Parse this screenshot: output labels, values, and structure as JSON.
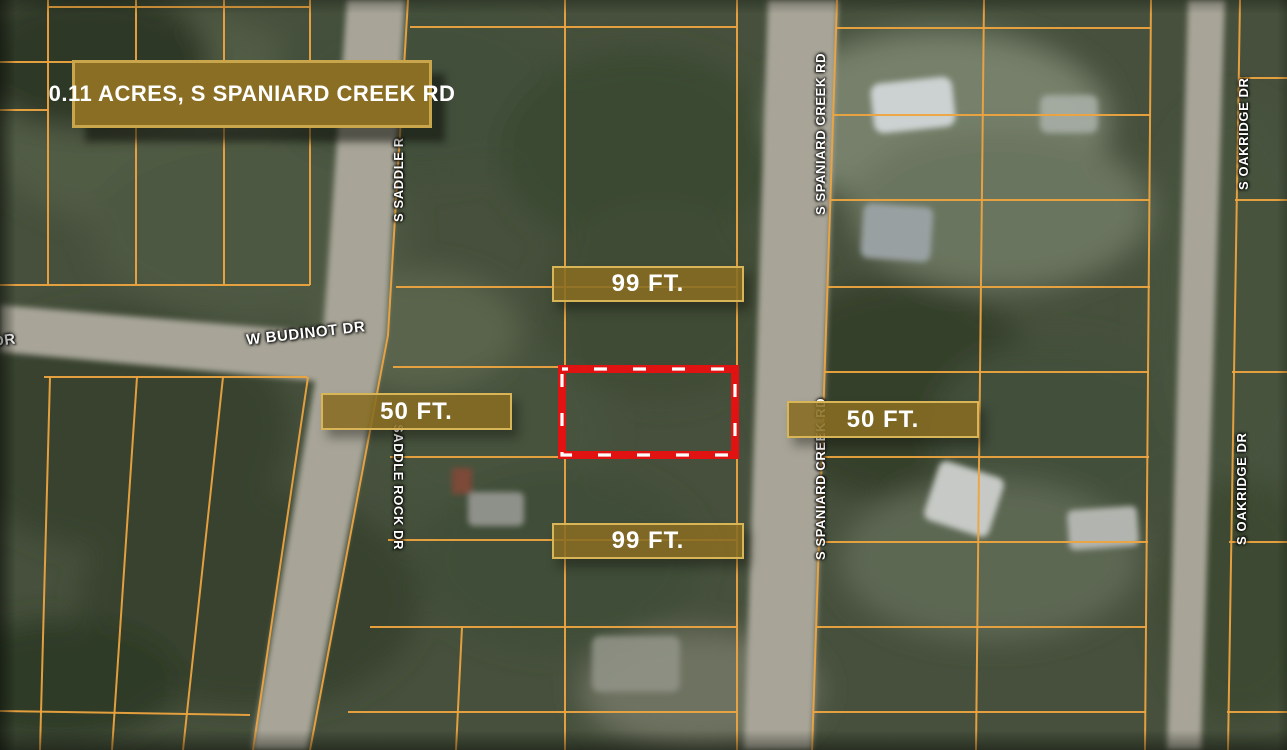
{
  "map": {
    "title_banner": "0.11 ACRES, S SPANIARD CREEK RD",
    "dimensions": {
      "top": "99 FT.",
      "bottom": "99 FT.",
      "left": "50 FT.",
      "right": "50 FT."
    },
    "streets": {
      "budinot": "W BUDINOT DR",
      "left_partial": "DR",
      "saddle_upper": "S SADDLE R",
      "saddle_lower": "SADDLE ROCK DR",
      "spaniard_upper": "S SPANIARD CREEK RD",
      "spaniard_lower": "S SPANIARD CREEK RD",
      "oakridge_upper": "S OAKRIDGE DR",
      "oakridge_lower": "S OAKRIDGE DR"
    },
    "colors": {
      "banner_bg": "#8a6e23",
      "banner_border": "#c9a64b",
      "label_border": "#d8b658",
      "parcel_line": "#eda43f",
      "highlight": "#e01212",
      "road": "#a8a598",
      "text": "#ffffff"
    }
  }
}
